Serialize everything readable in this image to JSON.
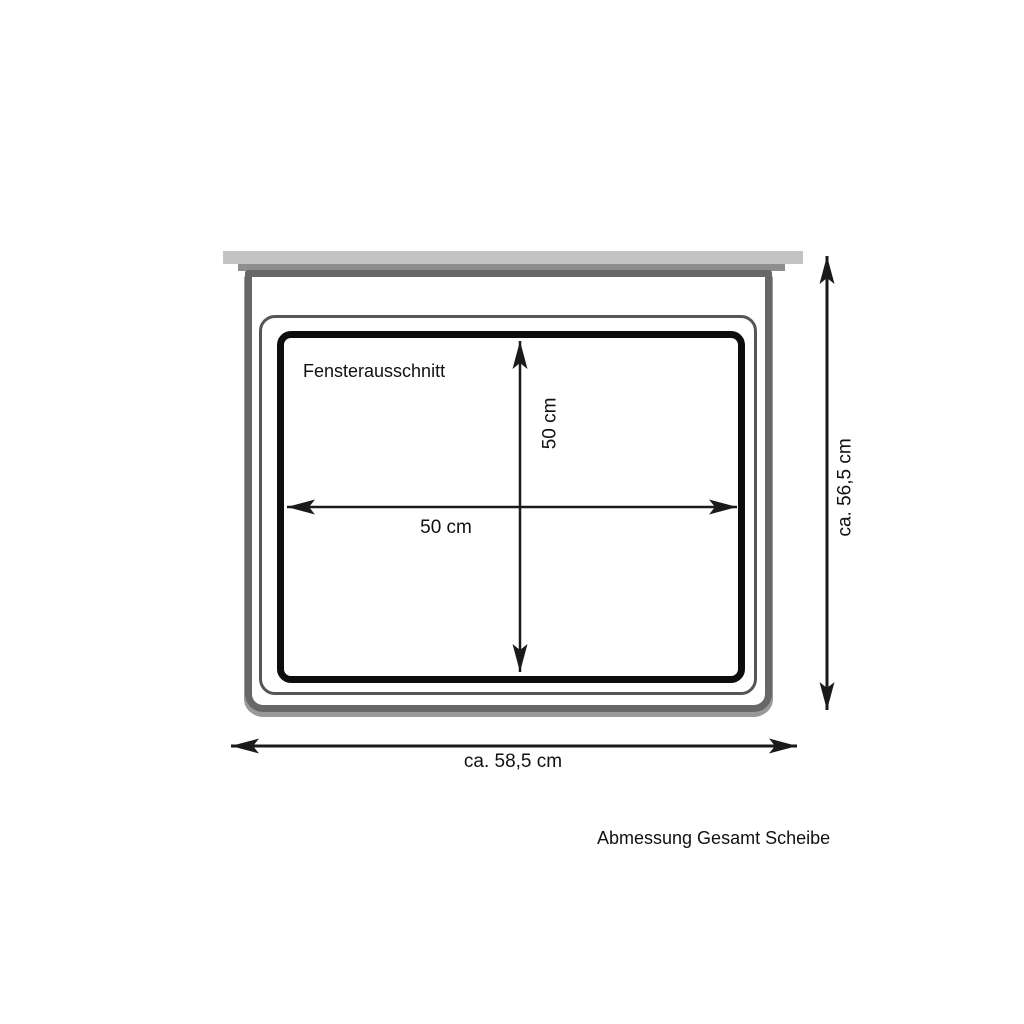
{
  "drawing": {
    "cutout_label": "Fensterausschnitt",
    "inner_width": "50 cm",
    "inner_height": "50 cm",
    "total_height": "ca. 56,5 cm",
    "total_width": "ca. 58,5 cm",
    "caption": "Abmessung Gesamt Scheibe"
  },
  "colors": {
    "background": "#ffffff",
    "top_rail_light": "#c3c3c3",
    "top_rail_mid": "#8d8d8d",
    "outer_frame": "#676767",
    "inner_frame": "#565656",
    "cutout_border": "#0d0d0d",
    "frame_shadow": "#999999",
    "dimension_lines": "#1a1a1a"
  }
}
